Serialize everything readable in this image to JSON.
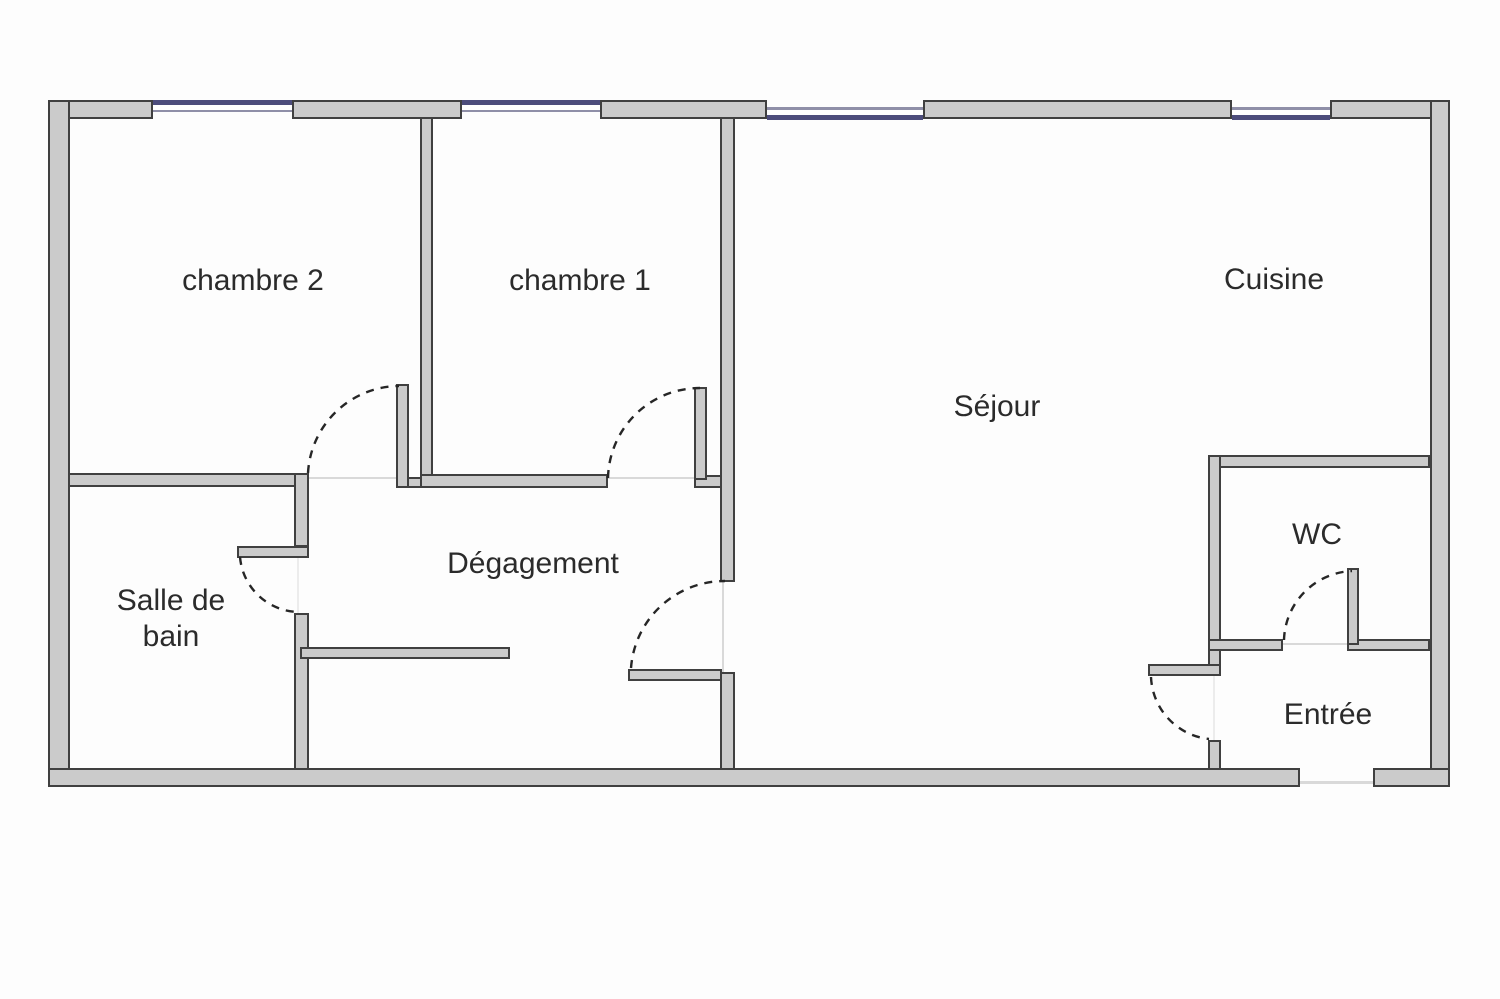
{
  "plan": {
    "rooms": {
      "chambre2": "chambre 2",
      "chambre1": "chambre 1",
      "cuisine": "Cuisine",
      "sejour": "Séjour",
      "degagement": "Dégagement",
      "salle_de_bain_1": "Salle de",
      "salle_de_bain_2": "bain",
      "wc": "WC",
      "entree": "Entrée"
    }
  },
  "colors": {
    "bg": "#fdfdfd",
    "wall_fill": "#cbcbcb",
    "wall_outline": "#404040",
    "window_blue": "#4d4d7c",
    "window_gray": "#8f8fa8",
    "arc": "#262626",
    "threshold": "#d9d9d9",
    "label": "#2b2b2b"
  }
}
